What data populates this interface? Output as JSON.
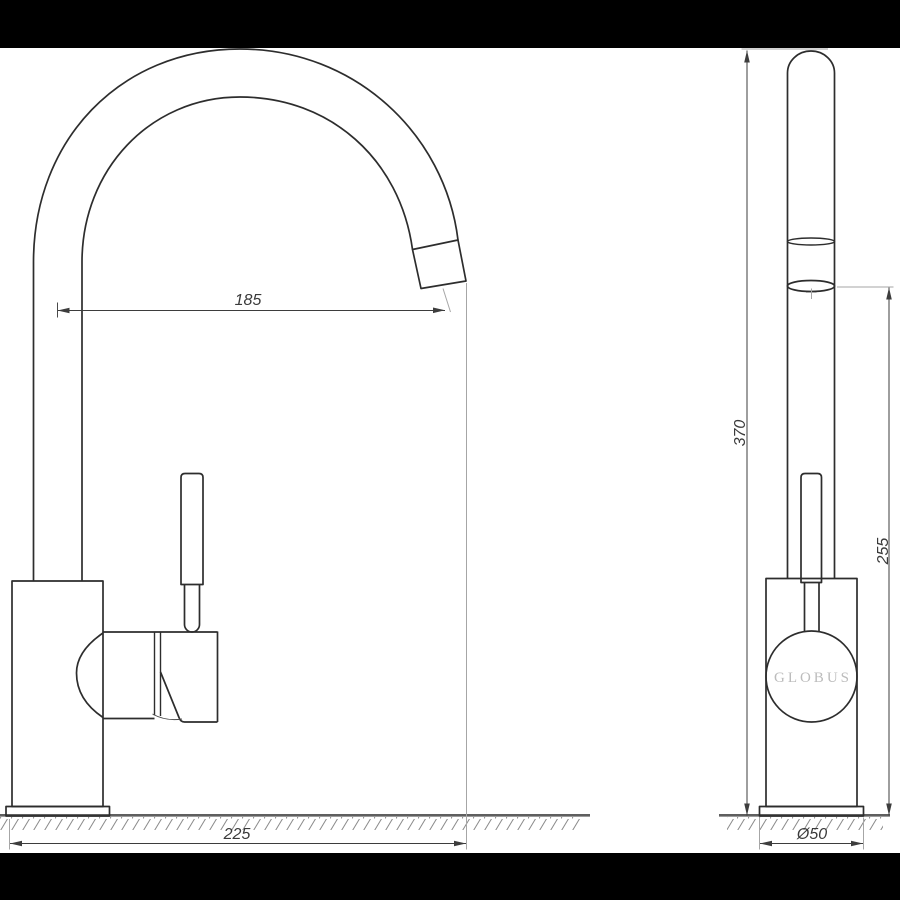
{
  "drawing": {
    "brand_label": "GLOBUS",
    "dimensions": {
      "spout_reach": "185",
      "overall_width": "225",
      "overall_height": "370",
      "spout_outlet_height": "255",
      "base_diameter": "Ø50"
    },
    "colors": {
      "outline": "#2d2d2d",
      "dimension": "#3d3d3d",
      "extension_line": "#a6a6a6",
      "ground_line": "#5f5f5f",
      "brand_text": "#bcbcbc",
      "letterbox": "#000000",
      "background": "#ffffff"
    }
  }
}
